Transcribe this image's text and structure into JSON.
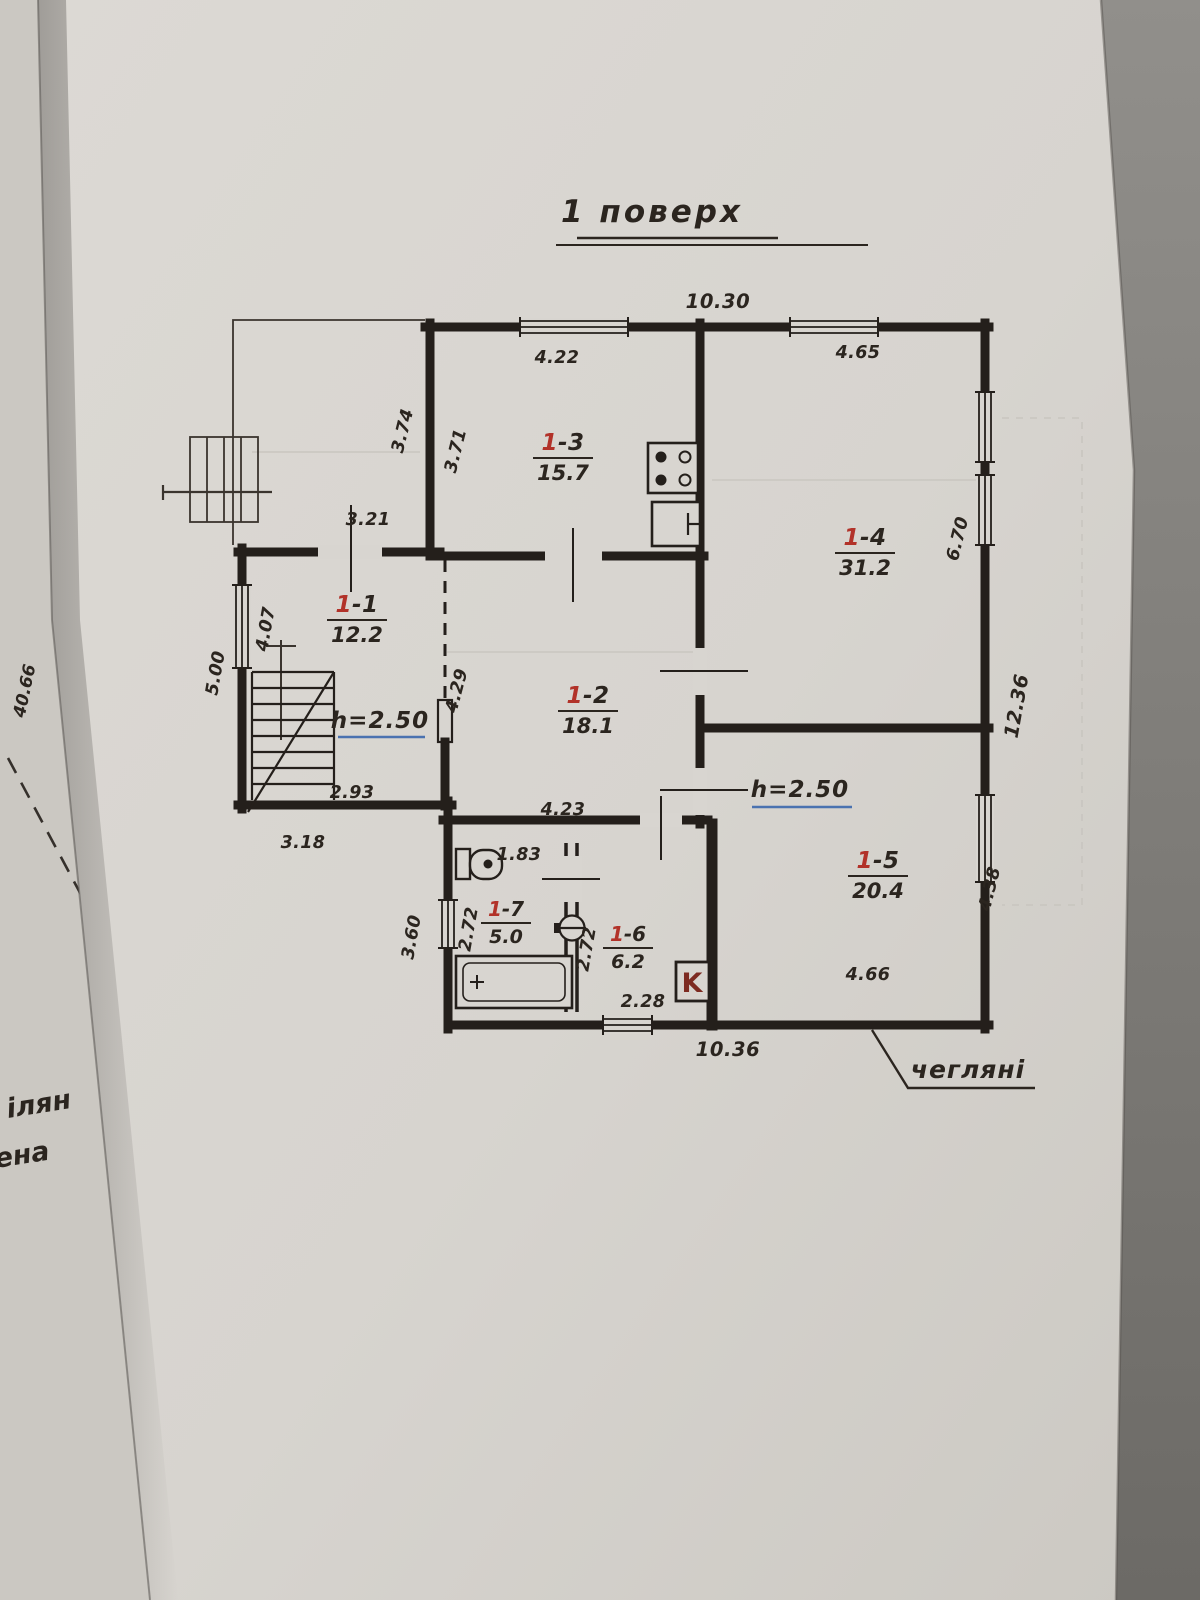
{
  "title": {
    "text": "1 поверх"
  },
  "rooms": [
    {
      "num": "1",
      "suffix": "-1",
      "area": "12.2"
    },
    {
      "num": "1",
      "suffix": "-2",
      "area": "18.1"
    },
    {
      "num": "1",
      "suffix": "-3",
      "area": "15.7"
    },
    {
      "num": "1",
      "suffix": "-4",
      "area": "31.2"
    },
    {
      "num": "1",
      "suffix": "-5",
      "area": "20.4"
    },
    {
      "num": "1",
      "suffix": "-6",
      "area": "6.2"
    },
    {
      "num": "1",
      "suffix": "-7",
      "area": "5.0"
    }
  ],
  "heights": {
    "room1": "h=2.50",
    "room5": "h=2.50"
  },
  "dims": {
    "top_total": "10.30",
    "room3_width": "4.22",
    "room4_width": "4.65",
    "terrace_height": "3.74",
    "room3_depth": "3.71",
    "room1_door_span": "3.21",
    "room1_left_outer": "5.00",
    "room1_left_inner": "4.07",
    "passage_width": "4.29",
    "room1_width": "2.93",
    "left_wing_bottom": "3.18",
    "room2_width": "4.23",
    "room4_depth": "6.70",
    "right_total": "12.36",
    "bath_door": "1.83",
    "room7_depth": "2.72",
    "room6_depth": "2.72",
    "room6_width": "2.28",
    "bath_left_outer": "3.60",
    "room5_width": "4.66",
    "room5_depth": "4.38",
    "bottom_total": "10.36"
  },
  "notes": {
    "wall_material": "чегляні",
    "boiler_symbol": "K"
  },
  "adjacent_sheet": {
    "number": "40.66",
    "partial_text_1": "ілян",
    "partial_text_2": "ена"
  },
  "colors": {
    "ink": "#27211c",
    "room_number_red": "#b23229",
    "height_underline_blue": "#4a72b0"
  }
}
